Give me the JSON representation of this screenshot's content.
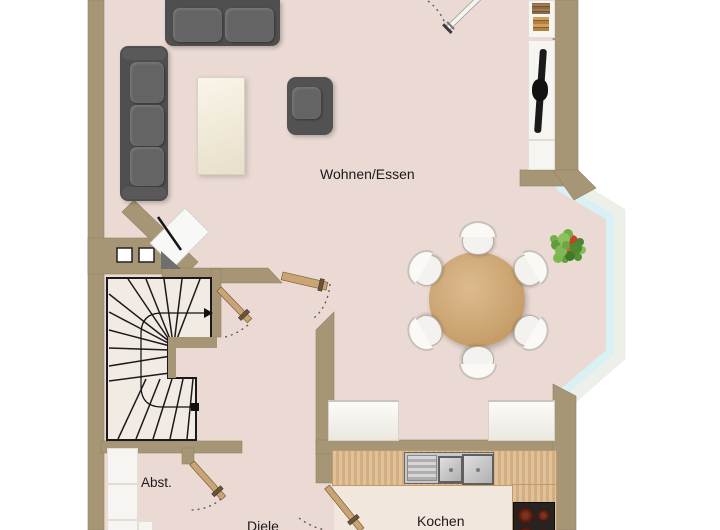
{
  "type": "floor-plan",
  "labels": {
    "living_dining": "Wohnen/Essen",
    "kitchen": "Kochen",
    "hallway": "Diele",
    "storage": "Abst."
  },
  "colors": {
    "outside": "#ffffff",
    "floor": "#ebdad3",
    "floor_light": "#f2e7dc",
    "stair": "#f2ebe4",
    "wall": "#a69676",
    "glass": "#d9f0f5",
    "frame": "#edefe9",
    "counter": "#dcb88a",
    "wood": "#c9a575",
    "line": "#1a1a1a",
    "sofa": "#4f4f4f",
    "cushion": "#646464",
    "chair": "#f4f2ee",
    "white_furniture": "#f6f5f1",
    "tv": "#1a1a1a",
    "sink": "#c9c9c9",
    "stove": "#262321",
    "burner": "#6b2113",
    "text": "#1a1a1a"
  }
}
